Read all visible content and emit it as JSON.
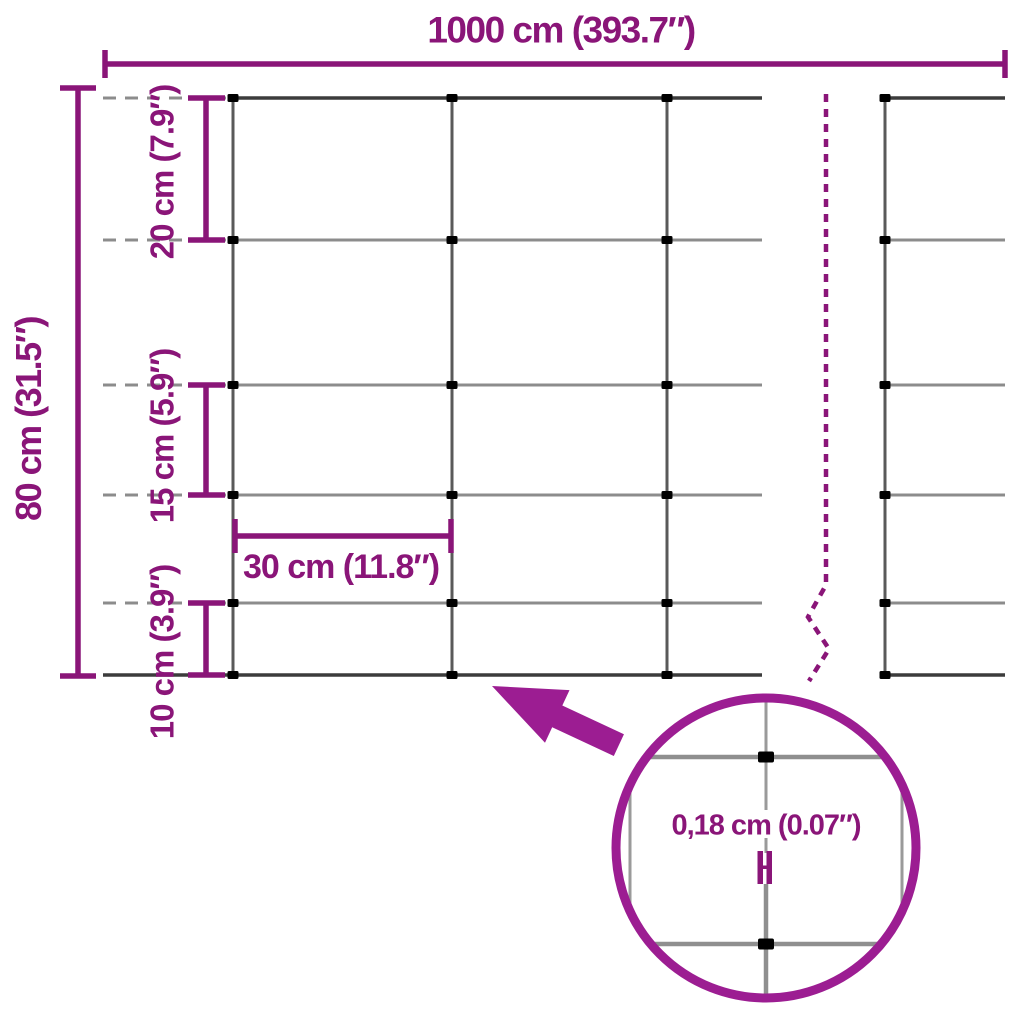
{
  "colors": {
    "dimension": "#8A1578",
    "accent": "#9C1D92",
    "wire-light": "#8C8C8C",
    "wire-dark": "#3C3C3C",
    "wire-vertical": "#5A5A5A",
    "background": "#FFFFFF"
  },
  "diagram": {
    "width_total": "1000 cm (393.7″)",
    "height_total": "80 cm (31.5″)",
    "row_spacing_top": "20 cm (7.9″)",
    "row_spacing_middle": "15 cm (5.9″)",
    "row_spacing_bottom": "10 cm (3.9″)",
    "column_spacing": "30 cm (11.8″)",
    "wire_thickness": "0,18 cm (0.07″)"
  }
}
